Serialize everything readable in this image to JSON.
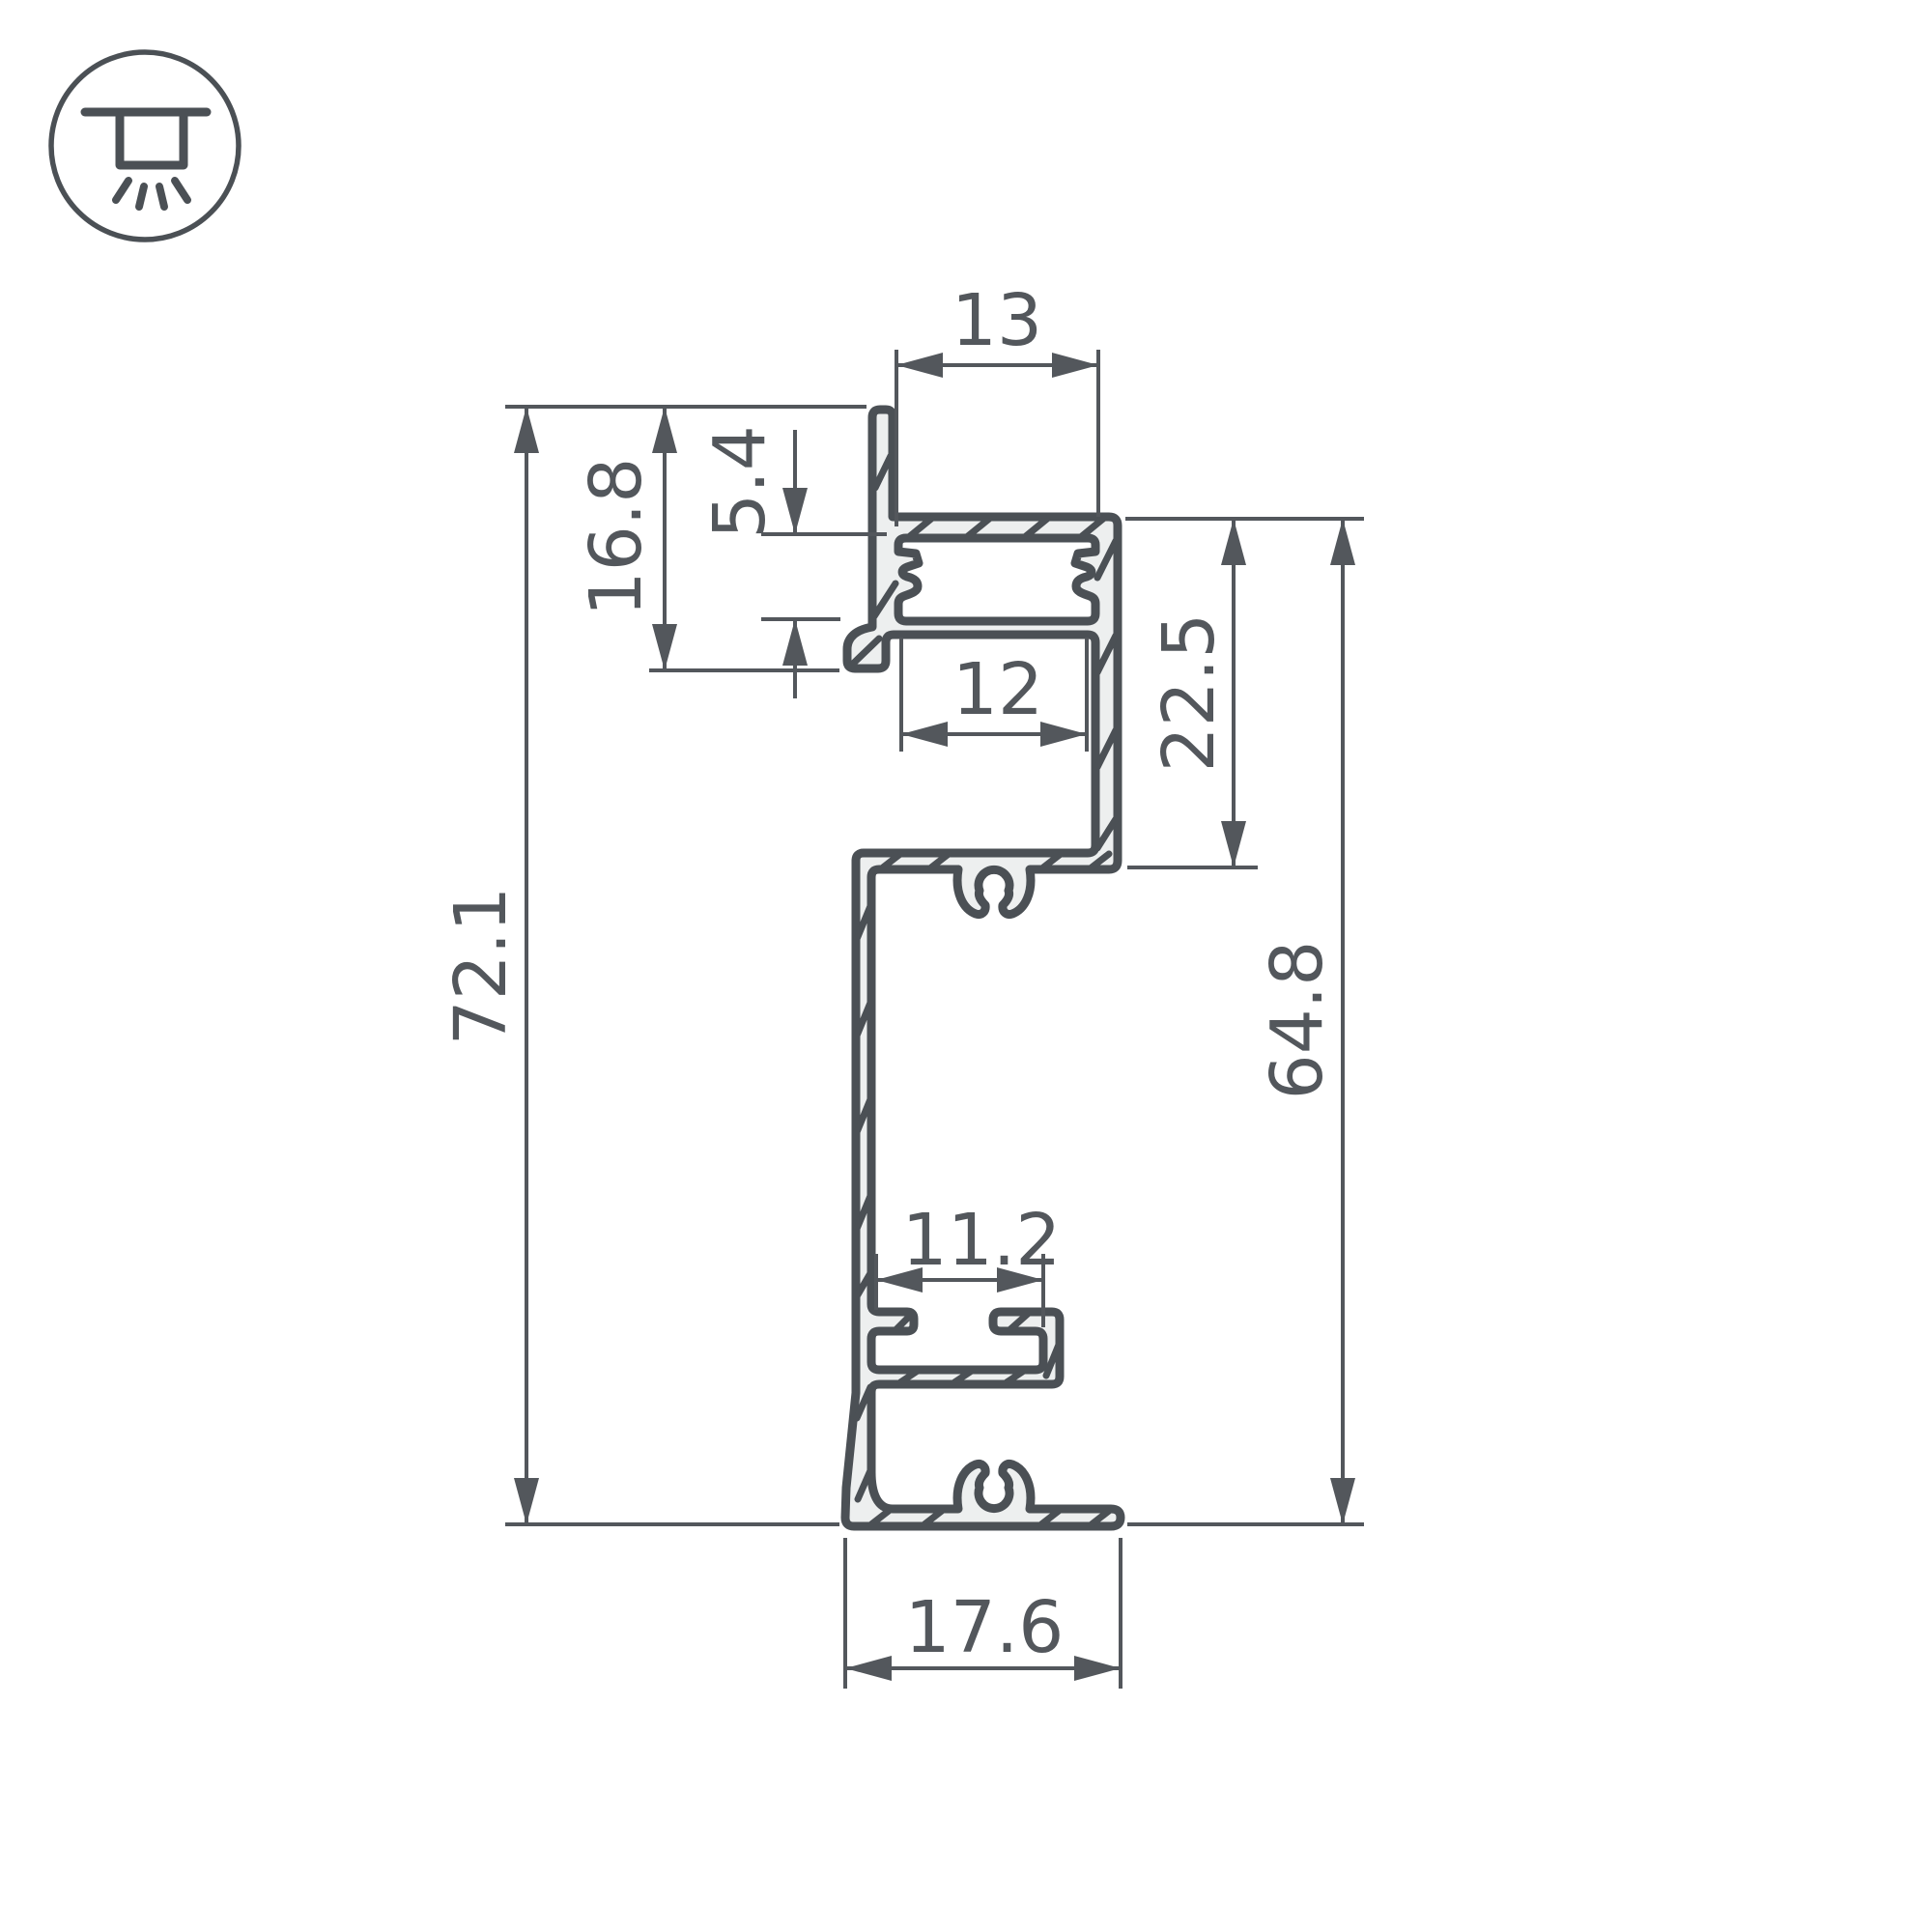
{
  "icon": {
    "name": "recessed-ceiling-light-icon"
  },
  "dimensions": {
    "top_opening_width": "13",
    "diffuser_recess_depth": "5.4",
    "flange_height": "16.8",
    "led_slot_width": "12",
    "channel_section_height": "22.5",
    "overall_height": "72.1",
    "body_height": "64.8",
    "clip_slot_width": "11.2",
    "base_width": "17.6"
  },
  "colors": {
    "line": "#4b5055",
    "dimension": "#53575c",
    "profile_fill": "#edefef",
    "background": "#ffffff"
  }
}
